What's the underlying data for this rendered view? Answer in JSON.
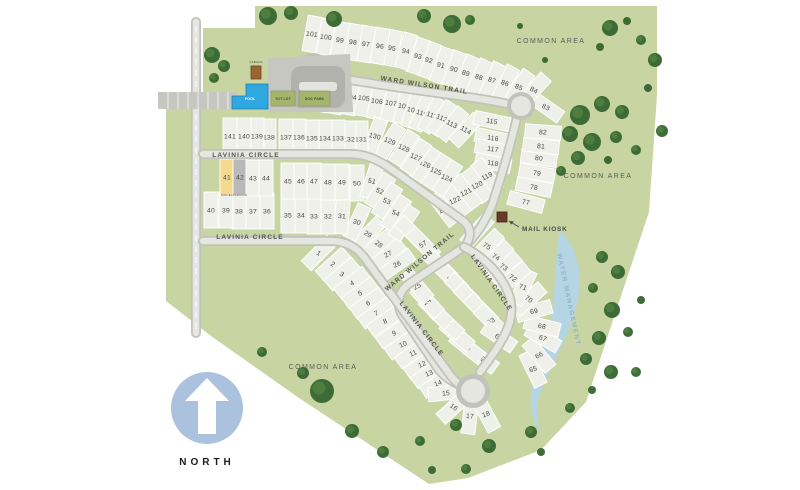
{
  "north": {
    "label": "NORTH"
  },
  "water_label": {
    "text": "WATER MANAGEMENT",
    "x": 567,
    "y": 300,
    "rot": 78
  },
  "mail_kiosk": {
    "label": "MAIL KIOSK",
    "x": 522,
    "y": 231
  },
  "amenities": {
    "cabana": "CABANA",
    "pool": "POOL",
    "tot_lot": "TOT LOT",
    "dog_park": "DOG PARK"
  },
  "lot_captions": [
    {
      "lot": 41,
      "text": "MODEL",
      "x": 227,
      "y": 196
    },
    {
      "lot": 42,
      "text": "PARKING",
      "x": 240,
      "y": 196
    }
  ],
  "street_labels": [
    {
      "text": "WARD WILSON TRAIL",
      "x": 424,
      "y": 87,
      "rot": 9
    },
    {
      "text": "WARD WILSON TRAIL",
      "x": 421,
      "y": 263,
      "rot": -40
    },
    {
      "text": "LAVINIA CIRCLE",
      "x": 246,
      "y": 157,
      "rot": 0
    },
    {
      "text": "LAVINIA CIRCLE",
      "x": 250,
      "y": 239,
      "rot": 0
    },
    {
      "text": "LAVINIA CIRCLE",
      "x": 420,
      "y": 330,
      "rot": 52
    },
    {
      "text": "LAVINIA CIRCLE",
      "x": 490,
      "y": 284,
      "rot": 55
    }
  ],
  "area_labels": [
    {
      "text": "COMMON AREA",
      "x": 551,
      "y": 43
    },
    {
      "text": "COMMON AREA",
      "x": 598,
      "y": 178
    },
    {
      "text": "COMMON AREA",
      "x": 323,
      "y": 369
    }
  ],
  "colors": {
    "site_green": "#c8d5a3",
    "parcel": "#f0f0ea",
    "parcel_model": "#f4da8e",
    "parcel_parking": "#b9b9b9",
    "road_curb": "#c2c2bc",
    "road_surface": "#e6e6e1",
    "tree_dark": "#35652f",
    "tree_light": "#4f8140",
    "pond": "#b5d4e4",
    "pool_blue": "#2fa8e0",
    "cabana_brown": "#9a6433",
    "kiosk_brown": "#6b3a2a",
    "amenity_green": "#a6b56e",
    "north_blue": "#abc2de"
  },
  "map": {
    "lots": [
      [
        1,
        319,
        253,
        45
      ],
      [
        2,
        333,
        264,
        48
      ],
      [
        3,
        342,
        274,
        50
      ],
      [
        4,
        352,
        283,
        52
      ],
      [
        5,
        360,
        293,
        54
      ],
      [
        6,
        368,
        303,
        55
      ],
      [
        7,
        376,
        313,
        55
      ],
      [
        8,
        385,
        321,
        55
      ],
      [
        9,
        394,
        333,
        55
      ],
      [
        10,
        403,
        344,
        55
      ],
      [
        11,
        413,
        353,
        55
      ],
      [
        12,
        422,
        364,
        55
      ],
      [
        13,
        429,
        373,
        55
      ],
      [
        14,
        438,
        383,
        58
      ],
      [
        15,
        446,
        393,
        84
      ],
      [
        16,
        454,
        407,
        48
      ],
      [
        17,
        470,
        416,
        7
      ],
      [
        18,
        486,
        414,
        -28
      ],
      [
        19,
        481,
        358,
        -53
      ],
      [
        20,
        467,
        347,
        -51
      ],
      [
        21,
        457,
        335,
        -49
      ],
      [
        22,
        447,
        323,
        -47
      ],
      [
        23,
        436,
        312,
        -45
      ],
      [
        24,
        427,
        301,
        -43
      ],
      [
        25,
        417,
        286,
        -40
      ],
      [
        26,
        397,
        264,
        55
      ],
      [
        27,
        388,
        254,
        52
      ],
      [
        28,
        379,
        244,
        50
      ],
      [
        29,
        368,
        234,
        45
      ],
      [
        30,
        357,
        222,
        25
      ],
      [
        31,
        342,
        216,
        5
      ],
      [
        32,
        328,
        216,
        0
      ],
      [
        33,
        314,
        216,
        0
      ],
      [
        34,
        301,
        215,
        0
      ],
      [
        35,
        288,
        215,
        0
      ],
      [
        36,
        267,
        211,
        0
      ],
      [
        37,
        253,
        211,
        0
      ],
      [
        38,
        239,
        211,
        0
      ],
      [
        39,
        226,
        210,
        0
      ],
      [
        40,
        211,
        210,
        0
      ],
      [
        41,
        227,
        177,
        0
      ],
      [
        42,
        240,
        177,
        0
      ],
      [
        43,
        253,
        178,
        0
      ],
      [
        44,
        266,
        178,
        0
      ],
      [
        45,
        288,
        181,
        0
      ],
      [
        46,
        301,
        181,
        0
      ],
      [
        47,
        314,
        181,
        0
      ],
      [
        48,
        328,
        182,
        0
      ],
      [
        49,
        342,
        182,
        0
      ],
      [
        50,
        357,
        183,
        0
      ],
      [
        51,
        372,
        181,
        18
      ],
      [
        52,
        380,
        191,
        33
      ],
      [
        53,
        387,
        201,
        33
      ],
      [
        54,
        396,
        213,
        33
      ],
      [
        55,
        404,
        223,
        33
      ],
      [
        56,
        412,
        233,
        -45
      ],
      [
        57,
        423,
        244,
        -45
      ],
      [
        58,
        440,
        266,
        -45
      ],
      [
        59,
        451,
        278,
        -45
      ],
      [
        60,
        462,
        290,
        -45
      ],
      [
        61,
        471,
        300,
        -45
      ],
      [
        62,
        481,
        310,
        -45
      ],
      [
        63,
        491,
        321,
        -45
      ],
      [
        64,
        499,
        337,
        -55
      ],
      [
        65,
        533,
        369,
        -26
      ],
      [
        66,
        539,
        355,
        -40
      ],
      [
        67,
        543,
        338,
        -60
      ],
      [
        68,
        542,
        326,
        -76
      ],
      [
        69,
        534,
        311,
        75
      ],
      [
        70,
        529,
        299,
        48
      ],
      [
        71,
        523,
        287,
        26
      ],
      [
        72,
        513,
        278,
        50
      ],
      [
        73,
        504,
        267,
        48
      ],
      [
        74,
        496,
        257,
        46
      ],
      [
        75,
        487,
        246,
        44
      ],
      [
        76,
        477,
        231,
        42
      ],
      [
        77,
        526,
        202,
        -75
      ],
      [
        78,
        534,
        187,
        -78
      ],
      [
        79,
        537,
        173,
        -80
      ],
      [
        80,
        539,
        158,
        -82
      ],
      [
        81,
        541,
        146,
        -84
      ],
      [
        82,
        543,
        132,
        -86
      ],
      [
        83,
        546,
        107,
        -55
      ],
      [
        84,
        534,
        90,
        42
      ],
      [
        85,
        519,
        87,
        34
      ],
      [
        86,
        505,
        83,
        28
      ],
      [
        87,
        492,
        80,
        26
      ],
      [
        88,
        479,
        77,
        26
      ],
      [
        89,
        466,
        73,
        24
      ],
      [
        90,
        454,
        69,
        20
      ],
      [
        91,
        441,
        65,
        20
      ],
      [
        92,
        429,
        60,
        20
      ],
      [
        93,
        418,
        56,
        18
      ],
      [
        94,
        406,
        51,
        16
      ],
      [
        95,
        392,
        48,
        12
      ],
      [
        96,
        380,
        46,
        10
      ],
      [
        97,
        366,
        44,
        10
      ],
      [
        98,
        353,
        42,
        10
      ],
      [
        99,
        340,
        40,
        10
      ],
      [
        100,
        326,
        37,
        10
      ],
      [
        101,
        312,
        34,
        10
      ],
      [
        102,
        323,
        94,
        10
      ],
      [
        103,
        337,
        96,
        10
      ],
      [
        104,
        351,
        97,
        10
      ],
      [
        105,
        364,
        98,
        10
      ],
      [
        106,
        377,
        101,
        12
      ],
      [
        107,
        391,
        103,
        12
      ],
      [
        108,
        404,
        106,
        14
      ],
      [
        109,
        413,
        110,
        18
      ],
      [
        110,
        422,
        113,
        24
      ],
      [
        111,
        432,
        115,
        29
      ],
      [
        112,
        442,
        118,
        34
      ],
      [
        113,
        452,
        124,
        39
      ],
      [
        114,
        466,
        130,
        44
      ],
      [
        115,
        492,
        121,
        -78
      ],
      [
        116,
        493,
        138,
        -78
      ],
      [
        117,
        493,
        149,
        -78
      ],
      [
        118,
        493,
        163,
        -78
      ],
      [
        119,
        487,
        176,
        -37
      ],
      [
        120,
        477,
        185,
        -37
      ],
      [
        121,
        466,
        192,
        -37
      ],
      [
        122,
        455,
        200,
        -37
      ],
      [
        123,
        444,
        209,
        -37
      ],
      [
        124,
        447,
        178,
        33
      ],
      [
        125,
        436,
        171,
        33
      ],
      [
        126,
        425,
        164,
        33
      ],
      [
        127,
        416,
        157,
        33
      ],
      [
        128,
        404,
        148,
        33
      ],
      [
        129,
        390,
        141,
        33
      ],
      [
        130,
        375,
        136,
        20
      ],
      [
        131,
        361,
        139,
        0
      ],
      [
        132,
        349,
        139,
        0
      ],
      [
        133,
        338,
        138,
        0
      ],
      [
        134,
        325,
        138,
        0
      ],
      [
        135,
        312,
        138,
        0
      ],
      [
        136,
        299,
        137,
        0
      ],
      [
        137,
        286,
        137,
        0
      ],
      [
        138,
        269,
        137,
        0
      ],
      [
        139,
        257,
        136,
        0
      ],
      [
        140,
        244,
        136,
        0
      ],
      [
        141,
        230,
        136,
        0
      ]
    ],
    "trees": [
      [
        268,
        16,
        9
      ],
      [
        291,
        13,
        7
      ],
      [
        334,
        19,
        8
      ],
      [
        424,
        16,
        7
      ],
      [
        452,
        24,
        9
      ],
      [
        470,
        20,
        5
      ],
      [
        610,
        28,
        8
      ],
      [
        641,
        40,
        5
      ],
      [
        655,
        60,
        7
      ],
      [
        600,
        47,
        4
      ],
      [
        627,
        21,
        4
      ],
      [
        520,
        26,
        3
      ],
      [
        545,
        60,
        3
      ],
      [
        212,
        55,
        8
      ],
      [
        224,
        66,
        6
      ],
      [
        214,
        78,
        5
      ],
      [
        580,
        115,
        10
      ],
      [
        602,
        104,
        8
      ],
      [
        622,
        112,
        7
      ],
      [
        570,
        134,
        8
      ],
      [
        592,
        142,
        9
      ],
      [
        616,
        137,
        6
      ],
      [
        578,
        158,
        7
      ],
      [
        561,
        171,
        5
      ],
      [
        636,
        150,
        5
      ],
      [
        648,
        88,
        4
      ],
      [
        662,
        131,
        6
      ],
      [
        608,
        160,
        4
      ],
      [
        602,
        257,
        6
      ],
      [
        618,
        272,
        7
      ],
      [
        593,
        288,
        5
      ],
      [
        612,
        310,
        8
      ],
      [
        628,
        332,
        5
      ],
      [
        599,
        338,
        7
      ],
      [
        586,
        359,
        6
      ],
      [
        611,
        372,
        7
      ],
      [
        641,
        300,
        4
      ],
      [
        636,
        372,
        5
      ],
      [
        322,
        391,
        12
      ],
      [
        303,
        373,
        6
      ],
      [
        262,
        352,
        5
      ],
      [
        352,
        431,
        7
      ],
      [
        383,
        452,
        6
      ],
      [
        420,
        441,
        5
      ],
      [
        456,
        425,
        6
      ],
      [
        489,
        446,
        7
      ],
      [
        531,
        432,
        6
      ],
      [
        570,
        408,
        5
      ],
      [
        466,
        469,
        5
      ],
      [
        432,
        470,
        4
      ],
      [
        541,
        452,
        4
      ],
      [
        592,
        390,
        4
      ]
    ]
  }
}
